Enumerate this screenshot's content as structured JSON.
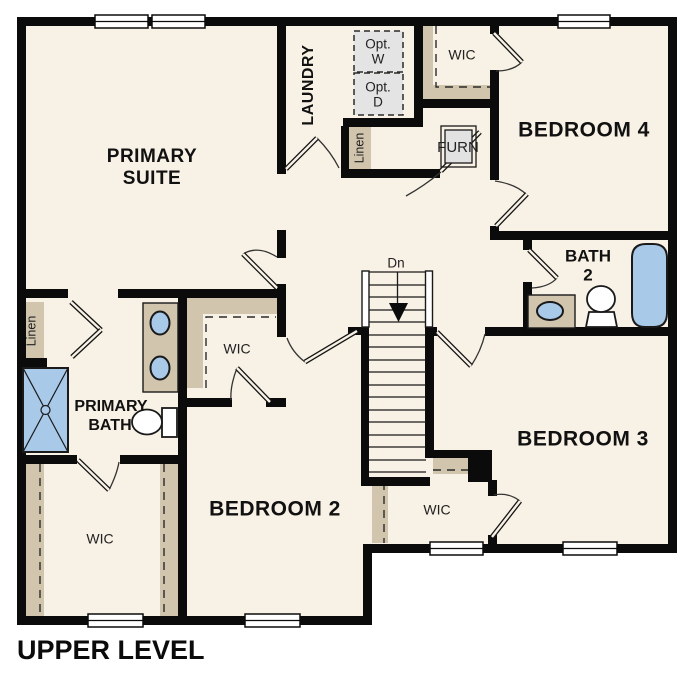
{
  "title": "UPPER LEVEL",
  "colors": {
    "floor": "#f8f1e5",
    "wall": "#0b0b0b",
    "shelf_tan": "#d2c5ad",
    "fixture_blue": "#a9c9e9",
    "optional_box_gray": "#e4e4e4"
  },
  "rooms": {
    "primary_suite": {
      "line1": "PRIMARY",
      "line2": "SUITE"
    },
    "laundry": {
      "label": "LAUNDRY"
    },
    "bedroom2": {
      "label": "BEDROOM 2"
    },
    "bedroom3": {
      "label": "BEDROOM 3"
    },
    "bedroom4": {
      "label": "BEDROOM 4"
    },
    "bath2": {
      "line1": "BATH",
      "line2": "2"
    },
    "primary_bath": {
      "line1": "PRIMARY",
      "line2": "BATH"
    },
    "wic_bedroom4": {
      "label": "WIC"
    },
    "wic_hall": {
      "label": "WIC"
    },
    "wic_primary": {
      "label": "WIC"
    },
    "wic_bedroom3": {
      "label": "WIC"
    },
    "linen_hall": {
      "label": "Linen"
    },
    "linen_primary": {
      "label": "Linen"
    },
    "opt_washer": {
      "line1": "Opt.",
      "line2": "W"
    },
    "opt_dryer": {
      "line1": "Opt.",
      "line2": "D"
    },
    "furnace": {
      "label": "FURN"
    },
    "stairs": {
      "label": "Dn"
    }
  }
}
